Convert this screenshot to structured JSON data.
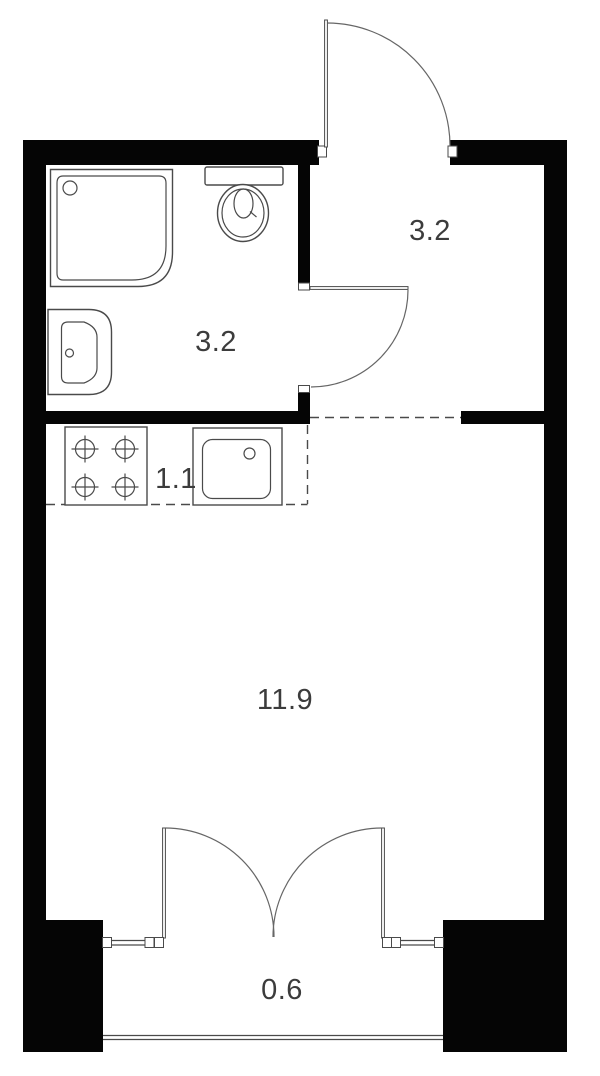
{
  "floor_plan": {
    "room_labels": {
      "bathroom": "3.2",
      "entrance_hall": "3.2",
      "kitchen": "1.1",
      "living_room": "11.9",
      "balcony": "0.6"
    },
    "fixture_icons": [
      "shower-cabin-icon",
      "toilet-icon",
      "washbasin-icon",
      "four-burner-stove-icon",
      "kitchen-sink-icon",
      "entrance-door-swing-icon",
      "bathroom-door-swing-icon",
      "french-balcony-doors-icon",
      "window-icon",
      "balcony-railing-icon"
    ],
    "colors": {
      "wall": "#050505",
      "line": "#4a4a4a",
      "label_text": "#3c3c3c",
      "background": "#ffffff"
    }
  }
}
